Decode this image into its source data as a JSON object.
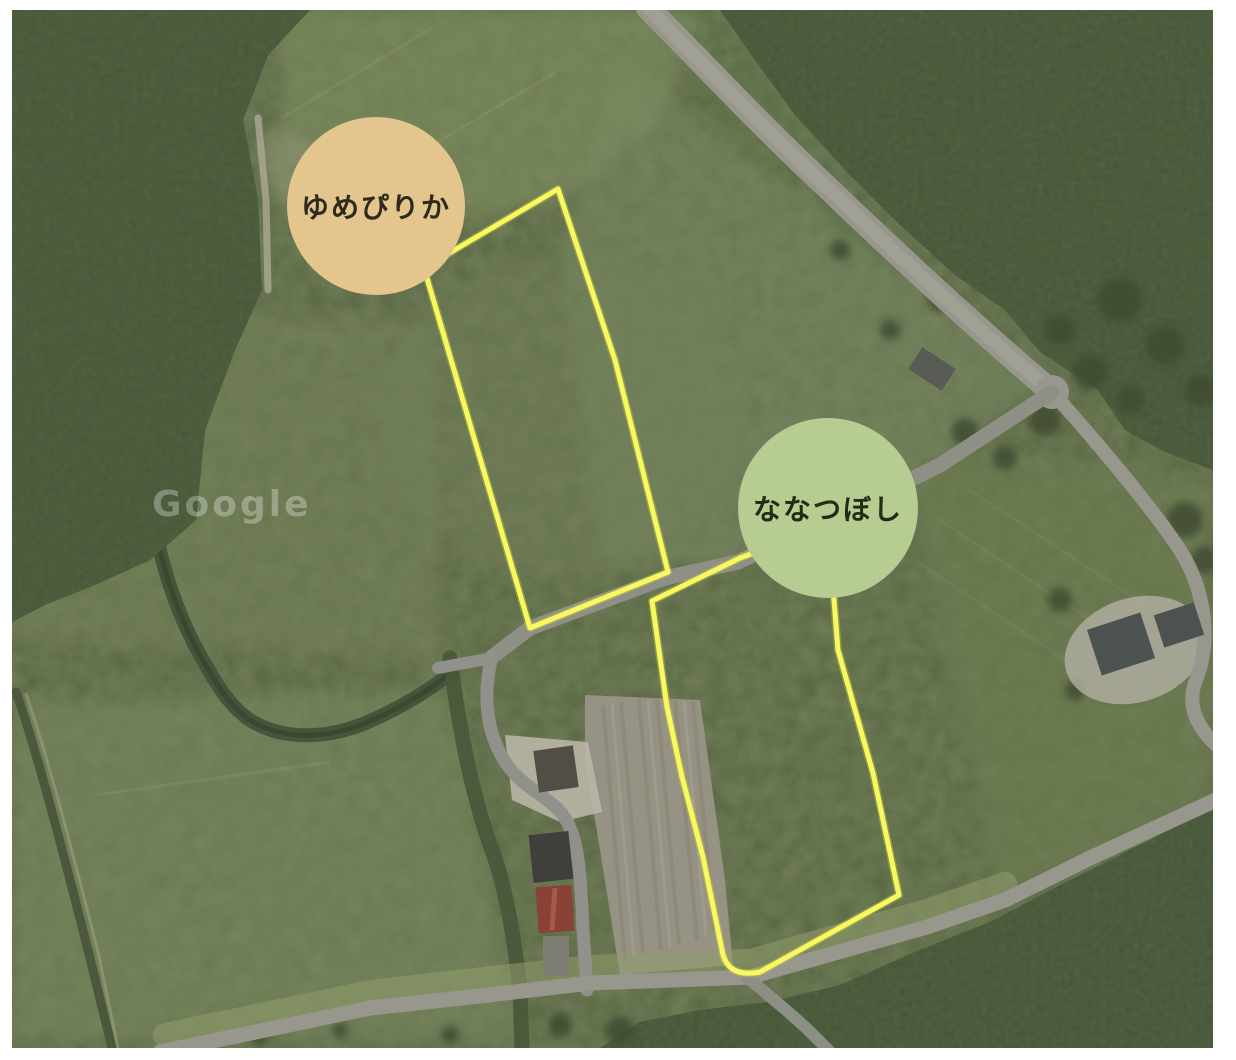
{
  "window": {
    "background": "#ffffff"
  },
  "map": {
    "kind": "satellite aerial photo of rice fields",
    "watermark": {
      "text": "Google"
    },
    "field_outline_color": "#f8f960",
    "plots": [
      {
        "id": "yumepirika",
        "label": "ゆめぴりか",
        "marker_color": "#e4c58e",
        "label_color": "#2e2a1c"
      },
      {
        "id": "nanatsuboshi",
        "label": "ななつぼし",
        "marker_color": "#b7cc90",
        "label_color": "#222c16"
      }
    ],
    "palette": {
      "field_green": "#78865e",
      "forest_green": "#47533a",
      "road_gray": "#97978d",
      "road_light": "#a6a69b",
      "dirt_tan": "#9b9689",
      "creek_green": "#45523b",
      "barn_red": "#8a4136",
      "roof_gray": "#4c524f",
      "border_white": "#ffffff"
    }
  }
}
